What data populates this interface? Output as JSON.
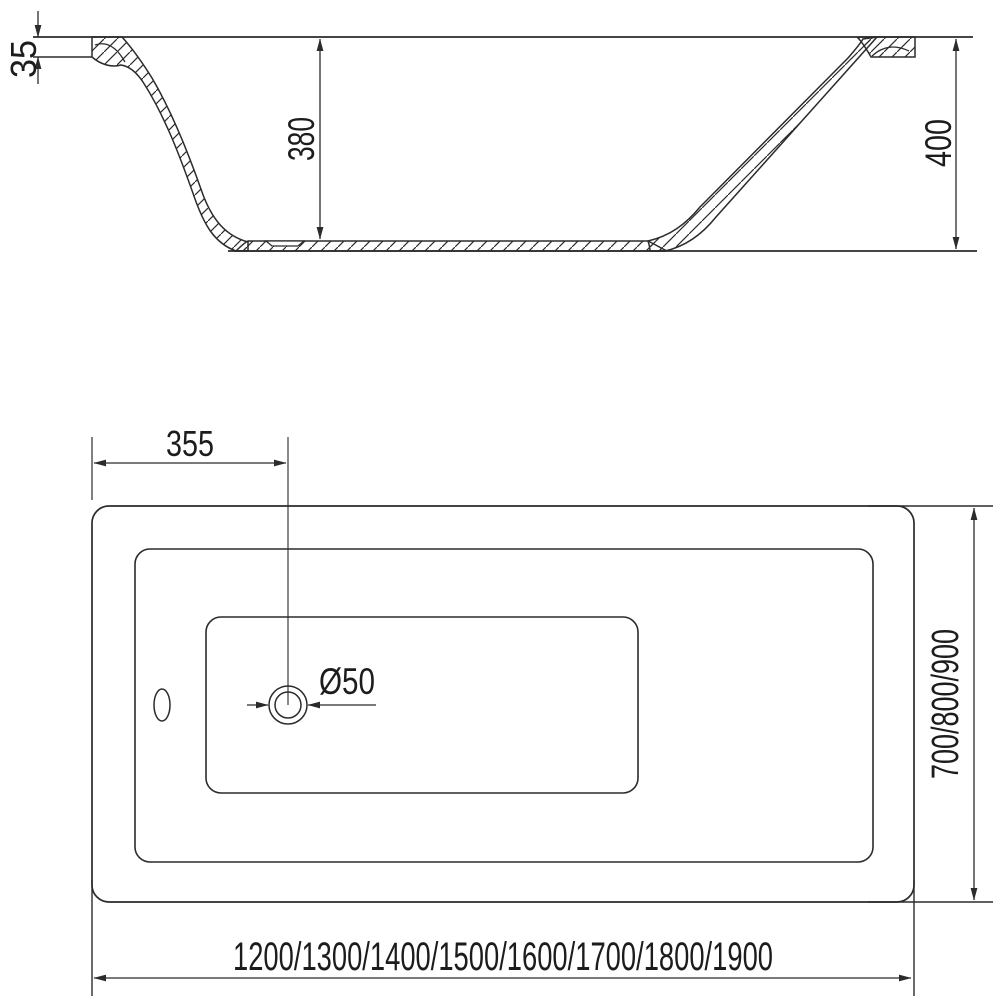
{
  "colors": {
    "line": "#2b2b2b",
    "text": "#1c1c1c",
    "background": "#ffffff"
  },
  "side_view": {
    "rim_thickness": "35",
    "inner_depth": "380",
    "overall_height": "400"
  },
  "plan_view": {
    "drain_offset": "355",
    "drain_diameter": "Ø50",
    "width_options": "700/800/900",
    "length_options": "1200/1300/1400/1500/1600/1700/1800/1900"
  }
}
